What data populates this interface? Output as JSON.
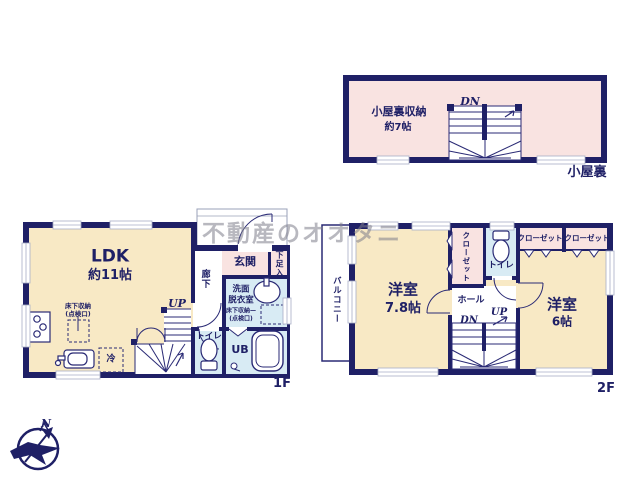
{
  "watermark": {
    "text": "不動産のオオタニ"
  },
  "compass": {
    "north": "N"
  },
  "colors": {
    "wall": "#1f2066",
    "line": "#2a2a75",
    "room_cream": "#f8e9c5",
    "room_pink": "#f9e3e1",
    "room_blue": "#d8ebf4",
    "text_navy": "#1f2066"
  },
  "attic": {
    "floor_label": "小屋裏",
    "storage_label": "小屋裏収納",
    "storage_size": "約7帖",
    "stairs_dn": "DN"
  },
  "floor1": {
    "floor_label": "1F",
    "ldk": {
      "label": "LDK",
      "size": "約11帖"
    },
    "floor_storage": {
      "line1": "床下収納",
      "line2": "(点検口)"
    },
    "fridge": "冷",
    "stairs_up": "UP",
    "corridor": "廊下",
    "genkan": "玄関",
    "shoe_storage": "下足入",
    "washroom": {
      "line1": "洗面",
      "line2": "脱衣室"
    },
    "washroom_storage": {
      "line1": "床下収納—",
      "line2": "(点検口)"
    },
    "toilet": "トイレ",
    "bath": "UB"
  },
  "floor2": {
    "floor_label": "2F",
    "balcony": "バルコニー",
    "room_a": {
      "label": "洋室",
      "size": "7.8帖"
    },
    "room_b": {
      "label": "洋室",
      "size": "6帖"
    },
    "closet_side": "クローゼット",
    "closet_top_left": "クローゼット",
    "closet_top_right": "クローゼット",
    "toilet": "トイレ",
    "hall": "ホール",
    "stairs_dn": "DN",
    "stairs_up": "UP"
  }
}
